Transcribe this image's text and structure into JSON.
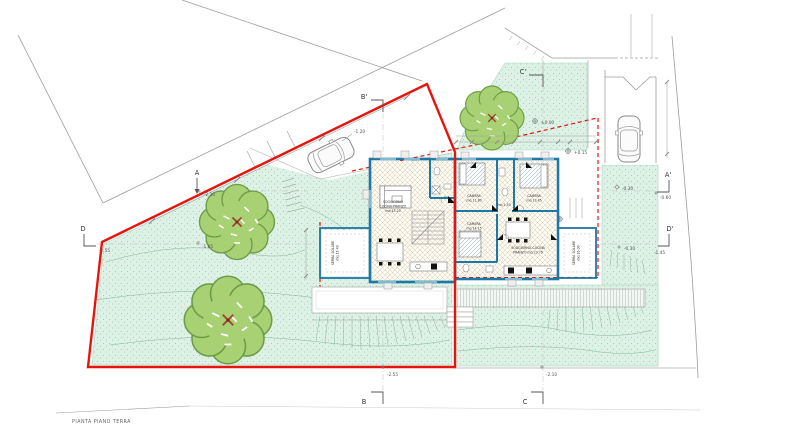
{
  "drawing": {
    "title": "PIANTA PIANO TERRA",
    "sections": {
      "a": "A",
      "a1": "A'",
      "b": "B",
      "b1": "B'",
      "c": "C",
      "c1": "C'",
      "d": "D",
      "d1": "D'"
    },
    "elevations": {
      "road": "-2.10",
      "tree": "-1.65",
      "d_left": "-2.55",
      "bottom_left": "-2.55",
      "bottom_center": "-2.10",
      "ramp": "-1.20",
      "courtyard": "±0.00",
      "entry": "+0.15",
      "a1_side": "-0.60",
      "driveway": "-0.30",
      "d1_side": "-1.45",
      "serra_side": "-0.30"
    },
    "rooms": {
      "sx_living": {
        "l1": "SOGGIORNO",
        "l2": "CUCINA-PRANZO",
        "l3": "mq 43.20"
      },
      "sx_serra": {
        "l1": "SERRA SOLARE",
        "l2": "mq 15.40"
      },
      "dx_cam1": {
        "l1": "CAMERA",
        "l2": "mq 11.80"
      },
      "dx_cam2": {
        "l1": "CAMERA",
        "l2": "mq 13.45"
      },
      "dx_hall": {
        "l1": "mq 2.50"
      },
      "dx_cam3": {
        "l1": "CAMERA",
        "l2": "mq 14.15"
      },
      "dx_living": {
        "l1": "SOGGIORNO-CUCINA",
        "l2": "PRANZO mq 23.70"
      },
      "dx_serra": {
        "l1": "SERRA SOLARE",
        "l2": "mq 16.00"
      }
    },
    "colors": {
      "boundary": "#e8140c",
      "walls": "#1f77a3",
      "green": "#def1e6"
    }
  }
}
